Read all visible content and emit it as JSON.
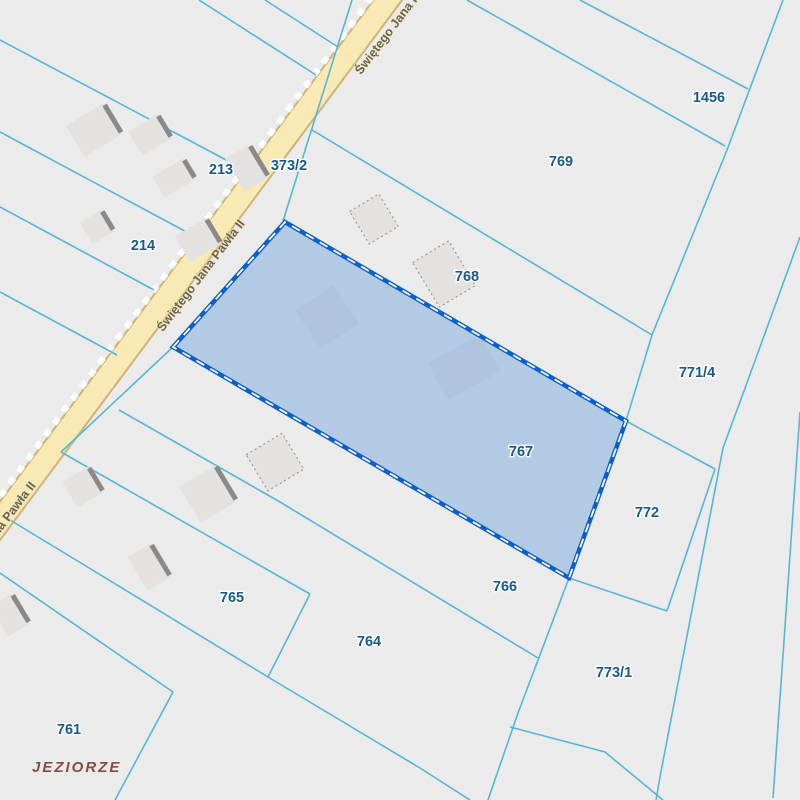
{
  "map": {
    "width": 800,
    "height": 800,
    "background_color": "#ebebeb",
    "parcel_line_color": "#55b6d8",
    "parcel_label_color": "#1a5a8a",
    "road_fill_color": "#f9e9b5",
    "road_casing_color": "#cdb478",
    "road_dash_color": "#ffffff",
    "road_label_color": "#6a6254",
    "building_fill_color": "#e3e2e0",
    "building_edge_color": "#8a8a8a",
    "building_dotted_color": "#9a9a9a",
    "selected_fill_color": "rgba(31,113,210,0.27)",
    "selected_border_color": "#0b5fc9",
    "selected_dash_color": "#ffffff",
    "place_label_color": "#8b4a43"
  },
  "road": {
    "name": "Świętego Jana Pawła II",
    "centerline": [
      [
        399,
        -15
      ],
      [
        -18,
        545
      ]
    ],
    "dashline": [
      [
        381,
        -15
      ],
      [
        -36,
        545
      ]
    ],
    "labels": [
      {
        "text": "Świętego Jana Pawła II",
        "x": 402,
        "y": 21,
        "angle": -52.8
      },
      {
        "text": "Świętego Jana Pawła II",
        "x": 204,
        "y": 278,
        "angle": -52.8
      },
      {
        "text": "Świętego Jana Pawła II",
        "x": -5,
        "y": 540,
        "angle": -52.8
      }
    ]
  },
  "selected_parcel": {
    "number": "767",
    "polygon": [
      [
        173,
        347
      ],
      [
        285,
        222
      ],
      [
        626,
        421
      ],
      [
        569,
        578
      ]
    ]
  },
  "parcels": [
    {
      "number": "213",
      "x": 221,
      "y": 174
    },
    {
      "number": "214",
      "x": 143,
      "y": 250
    },
    {
      "number": "373/2",
      "x": 289,
      "y": 170
    },
    {
      "number": "1456",
      "x": 709,
      "y": 102
    },
    {
      "number": "769",
      "x": 561,
      "y": 166
    },
    {
      "number": "768",
      "x": 467,
      "y": 281
    },
    {
      "number": "771/4",
      "x": 697,
      "y": 377
    },
    {
      "number": "767",
      "x": 521,
      "y": 456
    },
    {
      "number": "772",
      "x": 647,
      "y": 517
    },
    {
      "number": "766",
      "x": 505,
      "y": 591
    },
    {
      "number": "773/1",
      "x": 614,
      "y": 677
    },
    {
      "number": "764",
      "x": 369,
      "y": 646
    },
    {
      "number": "765",
      "x": 232,
      "y": 602
    },
    {
      "number": "761",
      "x": 69,
      "y": 734
    }
  ],
  "place_label": {
    "text": "JEZIORZE",
    "x": 32,
    "y": 772
  },
  "boundary_lines": [
    {
      "points": [
        [
          0,
          40
        ],
        [
          247,
          171
        ]
      ]
    },
    {
      "points": [
        [
          0,
          132
        ],
        [
          194,
          236
        ]
      ]
    },
    {
      "points": [
        [
          0,
          207
        ],
        [
          154,
          290
        ]
      ]
    },
    {
      "points": [
        [
          0,
          292
        ],
        [
          117,
          355
        ]
      ]
    },
    {
      "points": [
        [
          265,
          0
        ],
        [
          338,
          47
        ]
      ]
    },
    {
      "points": [
        [
          199,
          0
        ],
        [
          316,
          75
        ]
      ]
    },
    {
      "points": [
        [
          352,
          0
        ],
        [
          283,
          221
        ]
      ]
    },
    {
      "points": [
        [
          173,
          347
        ],
        [
          61,
          452
        ]
      ]
    },
    {
      "points": [
        [
          580,
          0
        ],
        [
          748,
          89
        ]
      ]
    },
    {
      "points": [
        [
          467,
          0
        ],
        [
          725,
          146
        ]
      ]
    },
    {
      "points": [
        [
          312,
          130
        ],
        [
          652,
          335
        ]
      ]
    },
    {
      "points": [
        [
          783,
          0
        ],
        [
          727,
          150
        ],
        [
          652,
          335
        ],
        [
          626,
          421
        ]
      ]
    },
    {
      "points": [
        [
          569,
          578
        ],
        [
          518,
          713
        ],
        [
          488,
          800
        ]
      ]
    },
    {
      "points": [
        [
          800,
          237
        ],
        [
          748,
          380
        ],
        [
          723,
          448
        ],
        [
          660,
          777
        ],
        [
          656,
          800
        ]
      ]
    },
    {
      "points": [
        [
          800,
          412
        ],
        [
          773,
          798
        ]
      ]
    },
    {
      "points": [
        [
          626,
          421
        ],
        [
          715,
          469
        ]
      ]
    },
    {
      "points": [
        [
          715,
          469
        ],
        [
          667,
          611
        ]
      ]
    },
    {
      "points": [
        [
          667,
          611
        ],
        [
          569,
          578
        ]
      ]
    },
    {
      "points": [
        [
          119,
          410
        ],
        [
          280,
          502
        ],
        [
          538,
          658
        ]
      ]
    },
    {
      "points": [
        [
          61,
          452
        ],
        [
          310,
          594
        ]
      ]
    },
    {
      "points": [
        [
          310,
          594
        ],
        [
          268,
          677
        ]
      ]
    },
    {
      "points": [
        [
          5,
          517
        ],
        [
          76,
          560
        ],
        [
          268,
          677
        ],
        [
          420,
          768
        ],
        [
          470,
          800
        ]
      ]
    },
    {
      "points": [
        [
          0,
          573
        ],
        [
          173,
          692
        ]
      ]
    },
    {
      "points": [
        [
          173,
          692
        ],
        [
          115,
          800
        ]
      ]
    },
    {
      "points": [
        [
          510,
          727
        ],
        [
          605,
          752
        ],
        [
          663,
          800
        ]
      ]
    }
  ],
  "buildings": [
    {
      "cx": 94,
      "cy": 130,
      "w": 44,
      "h": 36,
      "angle": -31,
      "style": "edge"
    },
    {
      "cx": 150,
      "cy": 135,
      "w": 34,
      "h": 28,
      "angle": -31,
      "style": "edge"
    },
    {
      "cx": 174,
      "cy": 178,
      "w": 36,
      "h": 24,
      "angle": -31,
      "style": "edge"
    },
    {
      "cx": 247,
      "cy": 168,
      "w": 28,
      "h": 38,
      "angle": -31,
      "style": "edge"
    },
    {
      "cx": 97,
      "cy": 227,
      "w": 25,
      "h": 25,
      "angle": -31,
      "style": "edge"
    },
    {
      "cx": 198,
      "cy": 240,
      "w": 36,
      "h": 30,
      "angle": -31,
      "style": "edge"
    },
    {
      "cx": 374,
      "cy": 219,
      "w": 34,
      "h": 38,
      "angle": -31,
      "style": "dotted"
    },
    {
      "cx": 444,
      "cy": 274,
      "w": 42,
      "h": 52,
      "angle": -31,
      "style": "dotted"
    },
    {
      "cx": 327,
      "cy": 317,
      "w": 46,
      "h": 46,
      "angle": -33,
      "style": "plain"
    },
    {
      "cx": 464,
      "cy": 367,
      "w": 60,
      "h": 42,
      "angle": -28,
      "style": "plain"
    },
    {
      "cx": 275,
      "cy": 462,
      "w": 42,
      "h": 42,
      "angle": -31,
      "style": "dotted"
    },
    {
      "cx": 208,
      "cy": 494,
      "w": 42,
      "h": 42,
      "angle": -31,
      "style": "edge"
    },
    {
      "cx": 83,
      "cy": 487,
      "w": 30,
      "h": 30,
      "angle": -31,
      "style": "edge"
    },
    {
      "cx": 149,
      "cy": 567,
      "w": 27,
      "h": 39,
      "angle": -31,
      "style": "edge"
    },
    {
      "cx": 10,
      "cy": 615,
      "w": 25,
      "h": 35,
      "angle": -31,
      "style": "edge"
    }
  ]
}
